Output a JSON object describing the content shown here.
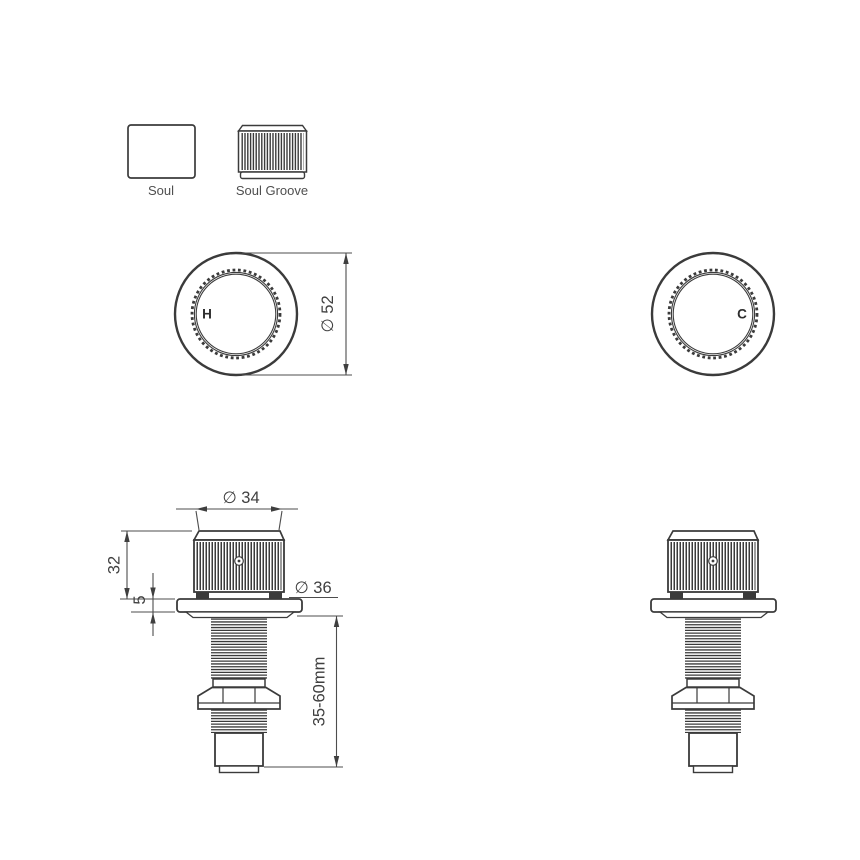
{
  "legend": {
    "soul": {
      "label": "Soul"
    },
    "soul_groove": {
      "label": "Soul Groove"
    }
  },
  "top_view": {
    "hot": {
      "label": "H"
    },
    "cold": {
      "label": "C"
    },
    "dimensions": {
      "outer_diameter": "∅ 52"
    }
  },
  "front_view": {
    "dimensions": {
      "knob_diameter": "∅ 34",
      "knob_height": "32",
      "flange_thickness": "5",
      "flange_diameter": "∅ 36",
      "mounting_range": "35-60mm"
    }
  },
  "colors": {
    "outline": "#3b3b3b",
    "dimension_line": "#4d4d4d",
    "text": "#3f3f3f",
    "background": "#ffffff"
  }
}
